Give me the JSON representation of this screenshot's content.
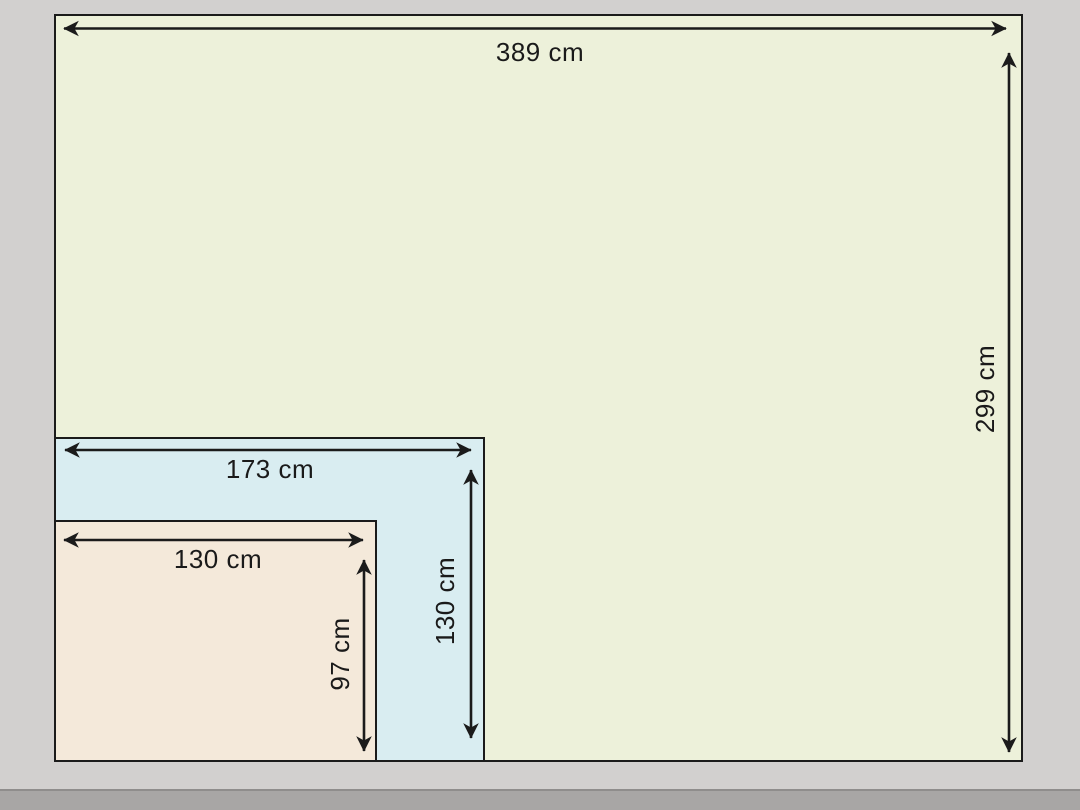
{
  "diagram": {
    "unit": "cm",
    "rectangles": [
      {
        "id": "outer",
        "width_cm": 389,
        "height_cm": 299,
        "width_label": "389 cm",
        "height_label": "299 cm",
        "fill": "#edf1da"
      },
      {
        "id": "middle",
        "width_cm": 173,
        "height_cm": 130,
        "width_label": "173 cm",
        "height_label": "130 cm",
        "fill": "#d9edf1"
      },
      {
        "id": "inner",
        "width_cm": 130,
        "height_cm": 97,
        "width_label": "130 cm",
        "height_label": "97 cm",
        "fill": "#f4e9da"
      }
    ],
    "colors": {
      "background": "#d2d0cf",
      "bottom_strip": "#a8a6a5",
      "outline": "#1b1b1b",
      "label_text": "#1a1a1a"
    }
  }
}
